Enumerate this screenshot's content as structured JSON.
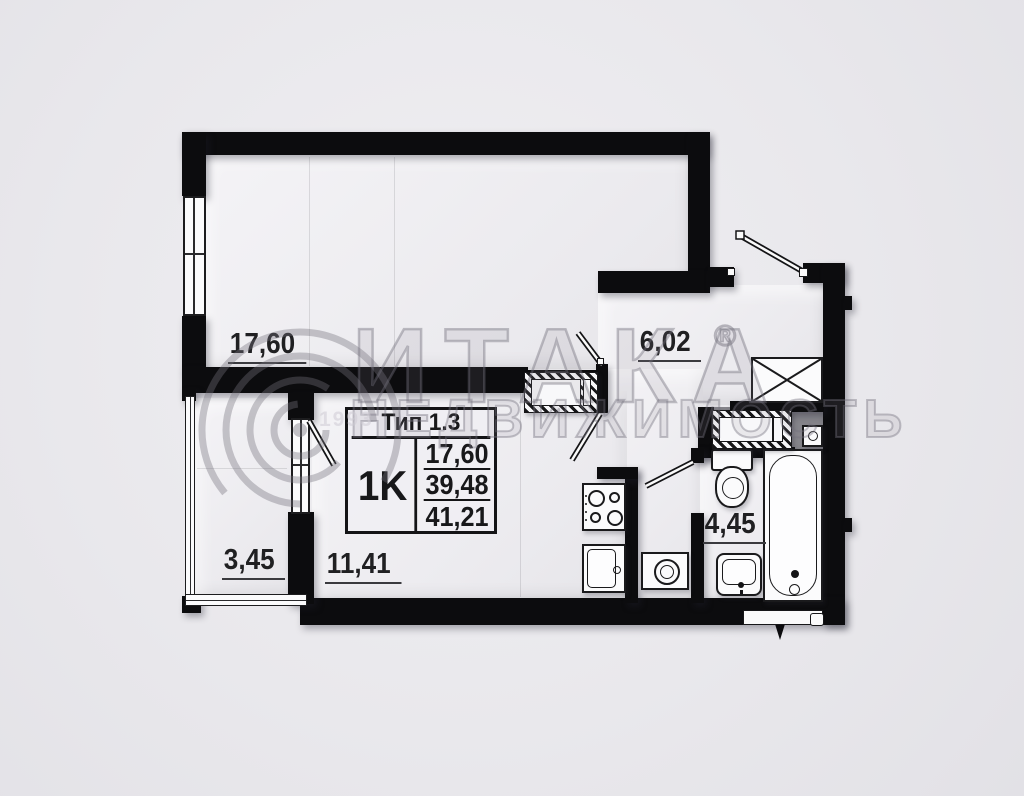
{
  "watermark": {
    "brand": "ИТАКА",
    "registered": "®",
    "subtitle": "НЕДВИЖИМОСТЬ",
    "year": "1993"
  },
  "info_table": {
    "type_label": "Тип 1.3",
    "unit_label": "1K",
    "areas": [
      "17,60",
      "39,48",
      "41,21"
    ]
  },
  "room_areas": {
    "living": "17,60",
    "hallway": "6,02",
    "balcony": "3,45",
    "kitchen": "11,41",
    "bathroom": "4,45"
  },
  "colors": {
    "wall": "#0c0c0e",
    "background": "#e9e8ec",
    "room_fill": "#f0eff2",
    "shaft_fill": "#85848a",
    "label_text": "#202022",
    "watermark": "#8b8993"
  },
  "fixtures": [
    "stove-4-burner",
    "kitchen-sink",
    "washing-machine",
    "toilet",
    "bathroom-sink",
    "bathtub",
    "wardrobe-x",
    "hatched-closet",
    "shaft-unit",
    "boiler"
  ]
}
